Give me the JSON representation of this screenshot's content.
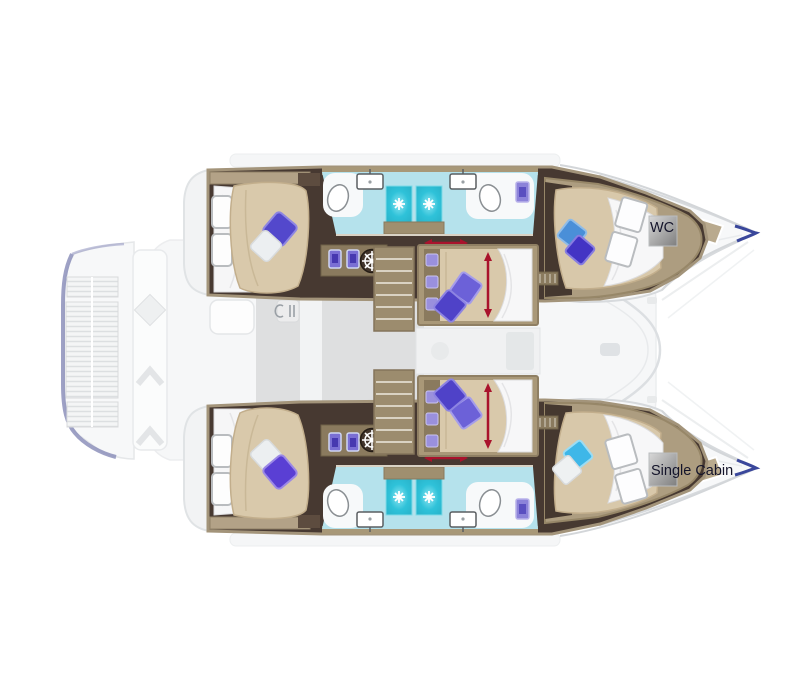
{
  "title": "Catamaran deck layout plan",
  "labels": {
    "wc": "WC",
    "single_cabin": "Single Cabin"
  },
  "icons": [
    "shower-jet-icon",
    "toilet-icon",
    "sink-icon",
    "double-sink-vanity-icon",
    "ship-wheel-icon",
    "galley-utensils-icon",
    "fan-vent-icon",
    "bed-dimension-arrow-icon",
    "corridor-dimension-arrow-icon",
    "stairs-icon",
    "deck-slats",
    "bow-window",
    "walkway-diamond"
  ],
  "colors": {
    "background": "#ffffff",
    "floor_dark_wood": "#473931",
    "wood_trim": "#a3947a",
    "cabin_trim_light": "#ad9d80",
    "bed_tan": "#d9c9ab",
    "duvet_white": "#f7f7f8",
    "bath_floor_cyan": "#b5e2ec",
    "shower_teal": "#2fc2d9",
    "pillow_purple": "#5348cc",
    "pillow_blue": "#4a8fd8",
    "pillow_light_blue": "#3eb7e8",
    "pillow_white": "#eceff1",
    "dimension_arrow_red": "#a9132c",
    "label_box_light": "#d6d6d6",
    "label_box_dark": "#7e7e7e",
    "label_text": "#14142a",
    "washed_structure_gray": "#e9ebec",
    "platform_edge_purple": "#8d90bb",
    "bow_accent_navy": "#3a479b"
  }
}
